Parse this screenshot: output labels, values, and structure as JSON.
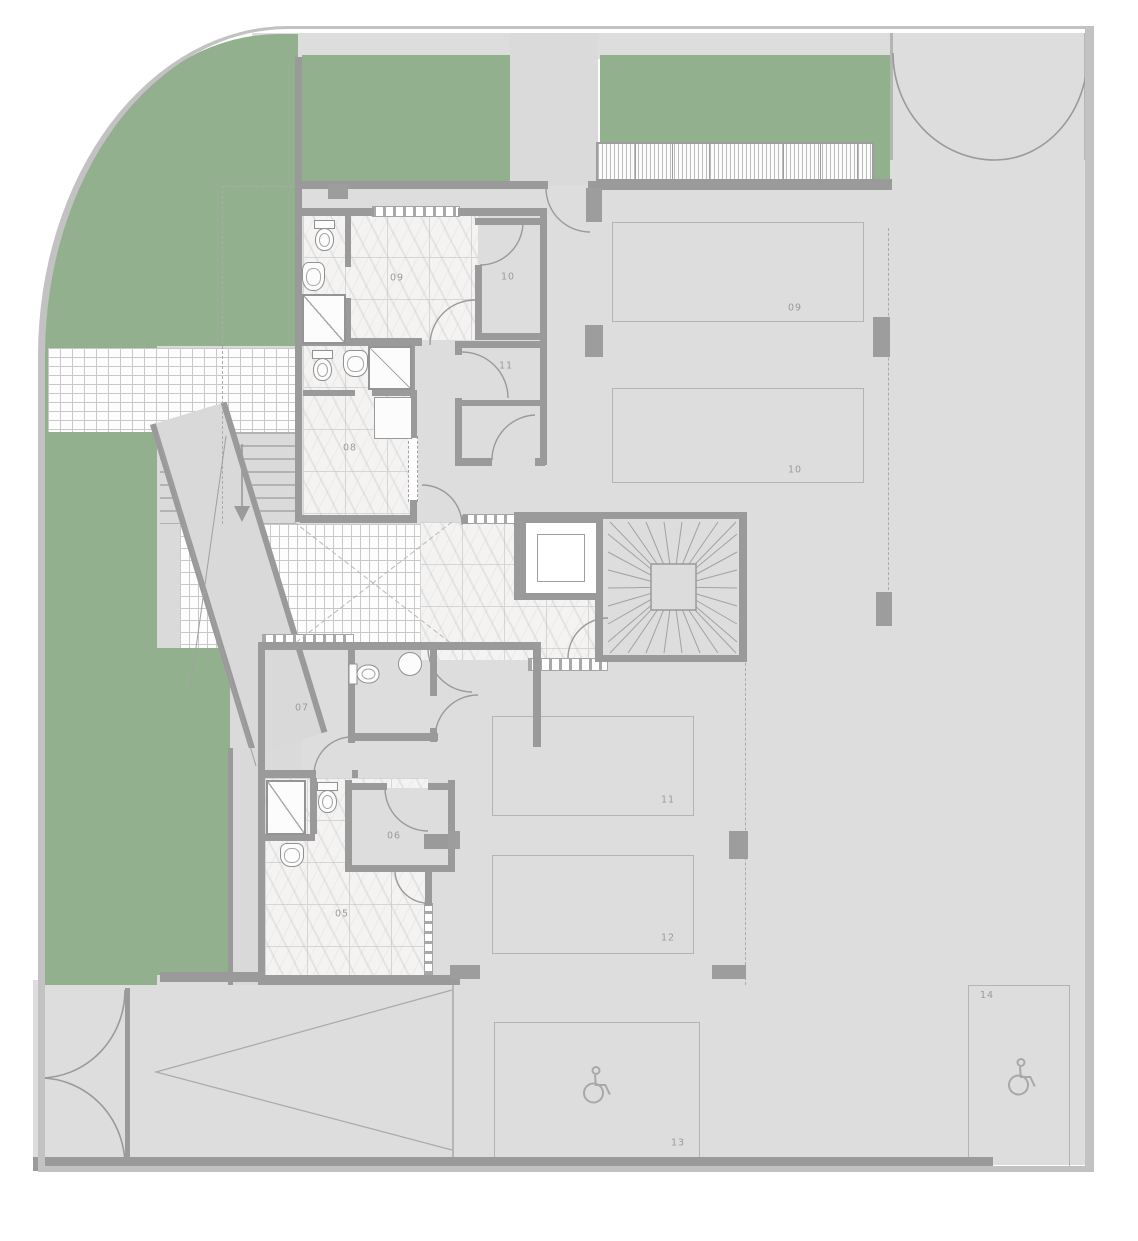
{
  "document": {
    "type": "architectural-floor-plan",
    "level": "basement-garage"
  },
  "rooms": {
    "r05": {
      "label": "05"
    },
    "r06": {
      "label": "06"
    },
    "r07": {
      "label": "07"
    },
    "r08": {
      "label": "08"
    },
    "r09": {
      "label": "09"
    },
    "r10": {
      "label": "10"
    },
    "r11": {
      "label": "11"
    }
  },
  "parking": {
    "p09": {
      "label": "09"
    },
    "p10": {
      "label": "10"
    },
    "p11": {
      "label": "11"
    },
    "p12": {
      "label": "12"
    },
    "p13": {
      "label": "13",
      "accessible": true
    },
    "p14": {
      "label": "14",
      "accessible": true
    }
  },
  "icons": {
    "wheelchair": "wheelchair-icon",
    "stair_arrow": "stair-down-arrow",
    "winder_stair": "winder-stair",
    "gate": "gate-swing-arc"
  },
  "colors": {
    "landscape_green": "#93b08e",
    "floor_gray": "#dcdddc",
    "exterior_gray": "#d9dad9",
    "wall_gray": "#9a9a9a",
    "boundary_gray": "#c2c2c2",
    "tile_white": "#f4f3f2",
    "label_gray": "#9b9b9b",
    "parking_line": "#b4b4b4",
    "dash_gray": "#ababab",
    "fixture_line": "#909090"
  }
}
